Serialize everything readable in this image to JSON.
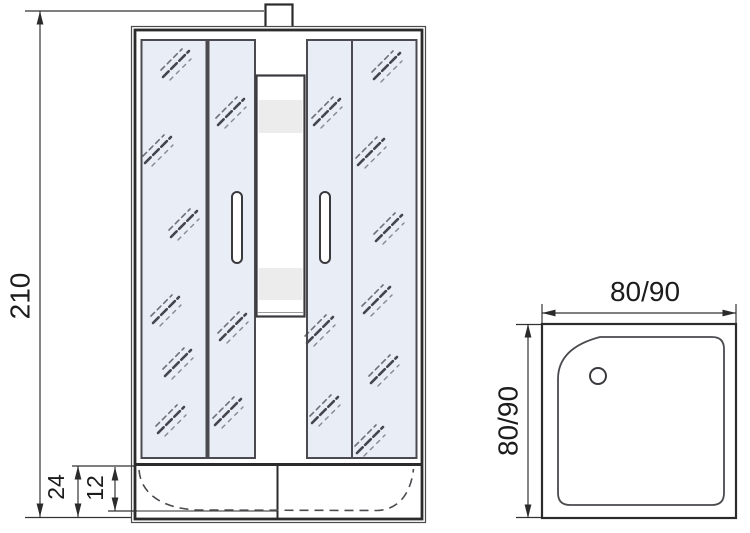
{
  "drawing": {
    "type": "shower-cabin-technical-drawing",
    "views": {
      "front_elevation": {
        "dim_total_height": "210",
        "dim_tray_height": "24",
        "dim_tray_rim_height": "12"
      },
      "tray_plan": {
        "dim_width": "80/90",
        "dim_depth": "80/90"
      }
    },
    "colors": {
      "line": "#2b2b2b",
      "dimension_line": "#333333",
      "glass_fill": "#e9edf6",
      "band_fill": "#ececec",
      "background": "#ffffff"
    }
  }
}
